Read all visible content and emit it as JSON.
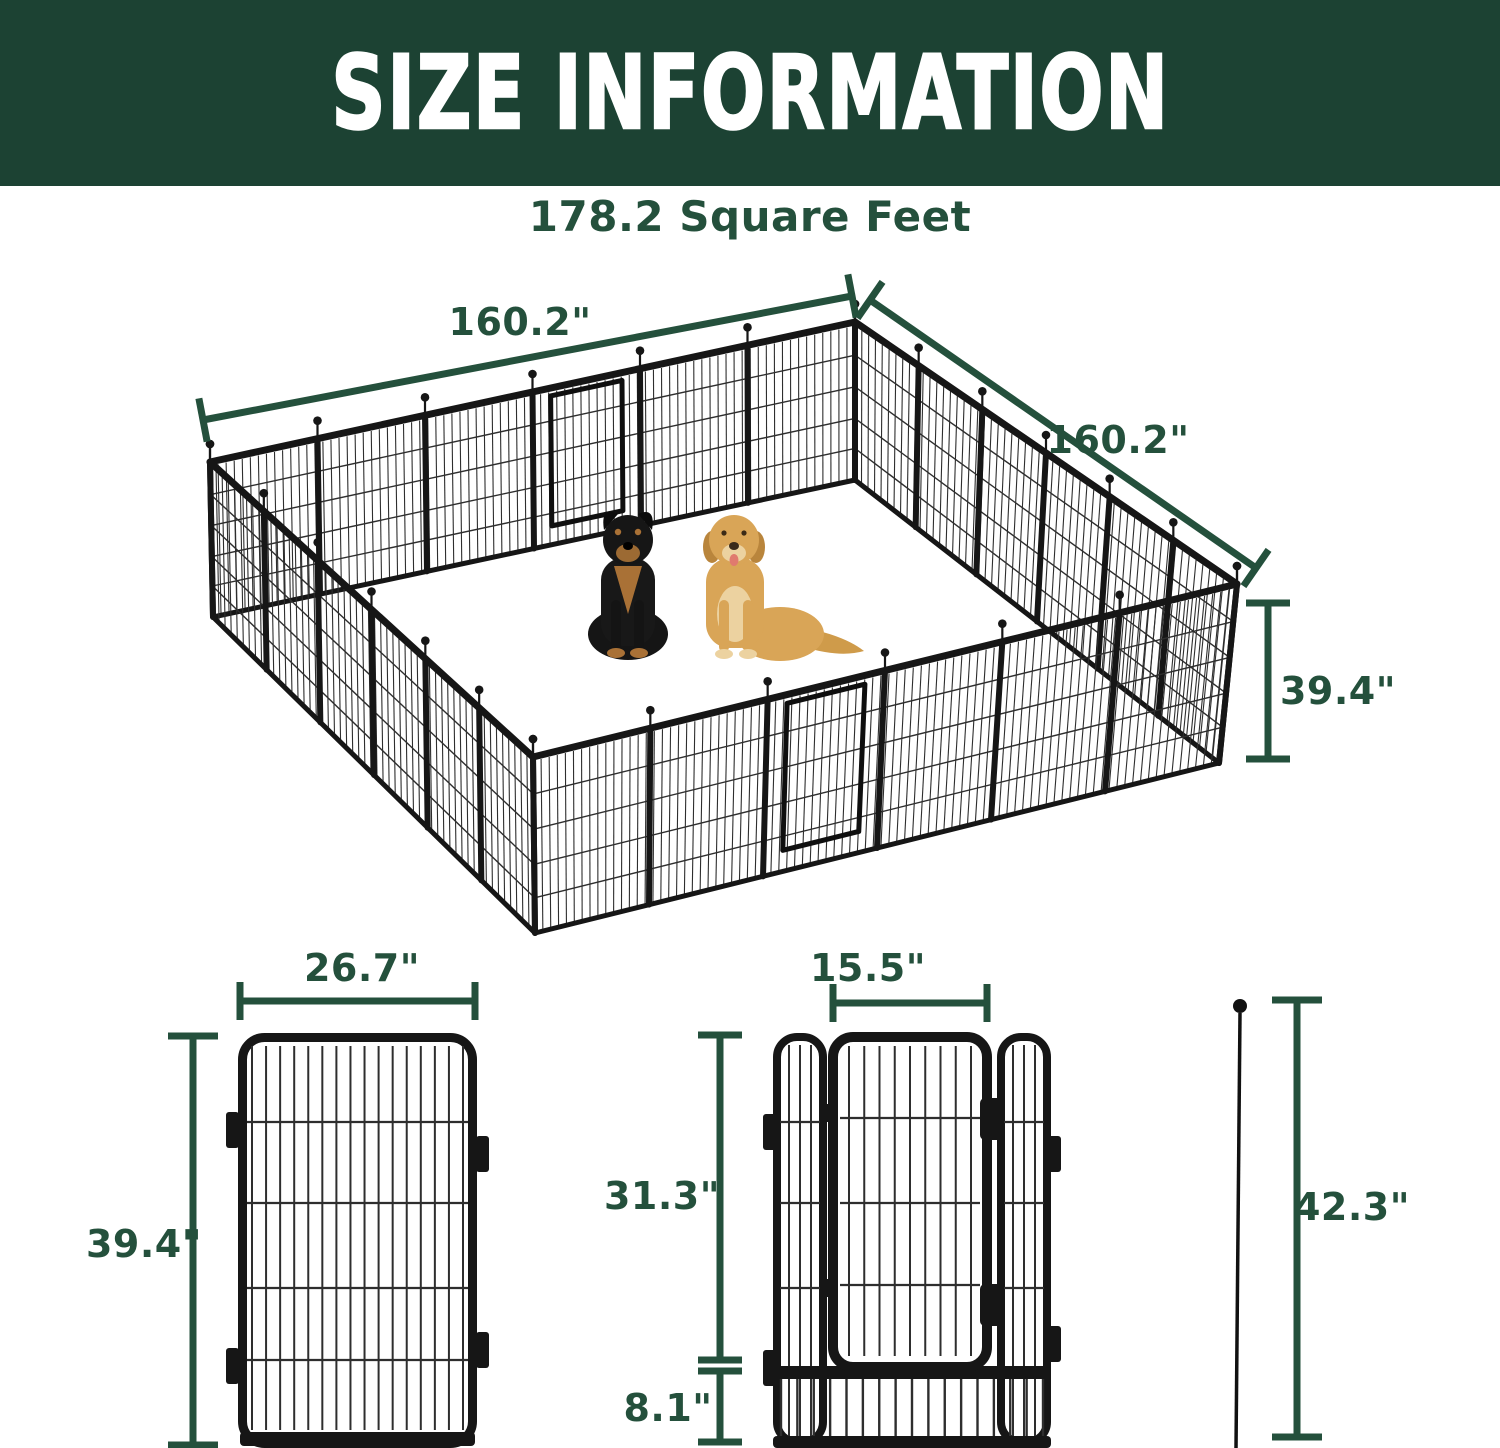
{
  "header": {
    "title": "SIZE INFORMATION"
  },
  "subtitle": "178.2 Square Feet",
  "pen": {
    "side_top_left": "160.2\"",
    "side_top_right": "160.2\"",
    "height": "39.4\""
  },
  "panel": {
    "width": "26.7\"",
    "height": "39.4\""
  },
  "door": {
    "width": "15.5\"",
    "height": "31.3\"",
    "bottom": "8.1\""
  },
  "stake": {
    "height": "42.3\""
  },
  "colors": {
    "banner": "#1c4233",
    "accent": "#24503c",
    "fence": "#161616",
    "wire": "#2e2e2e"
  }
}
